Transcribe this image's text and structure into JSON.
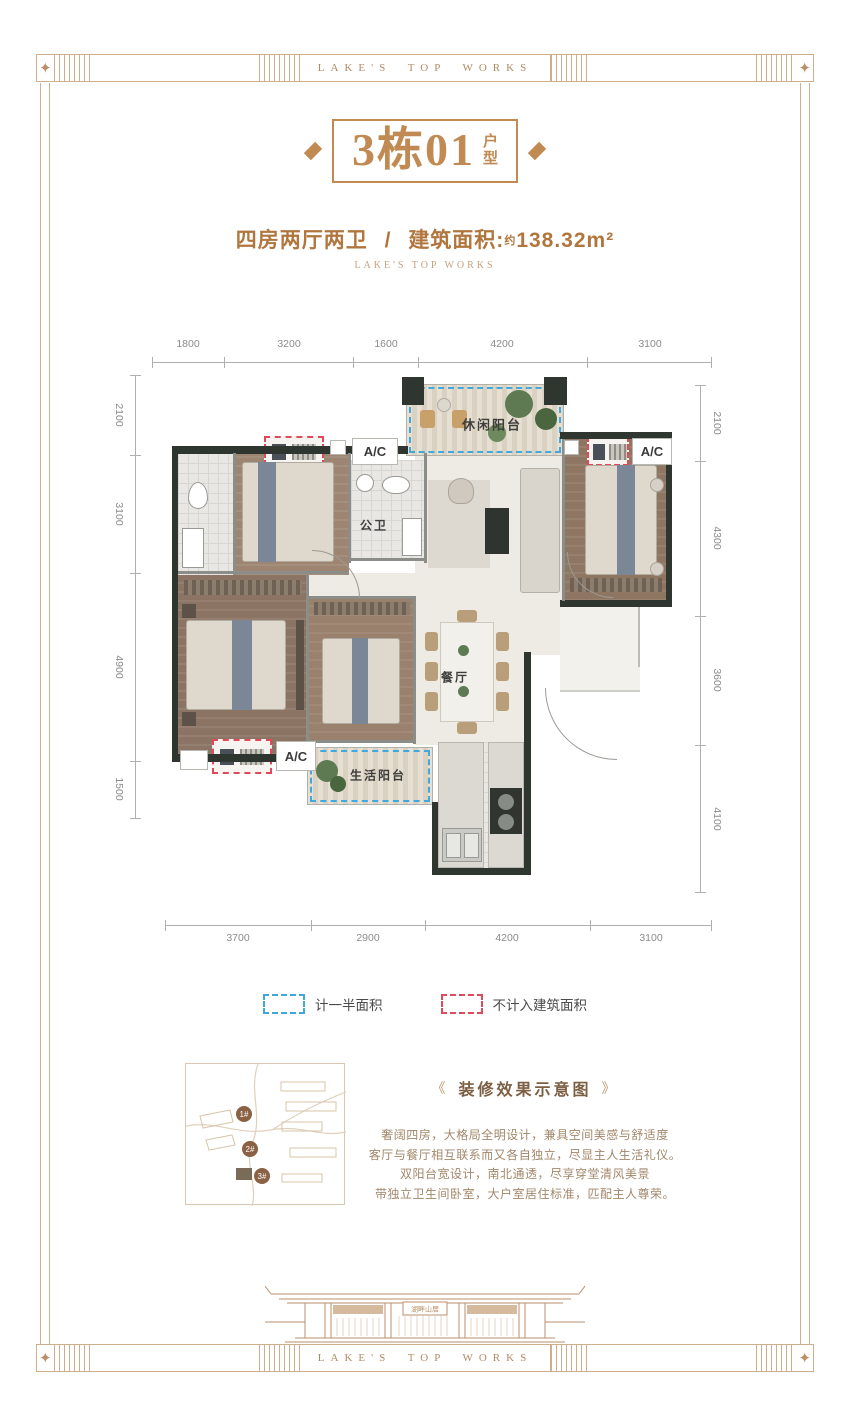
{
  "colors": {
    "accent_bronze": "#c08a52",
    "frame_tan": "#cfae8c",
    "dash_blue": "#3fa8dc",
    "dash_red": "#e0495a",
    "wall_dark": "#2e362f"
  },
  "frame": {
    "band_text": "LAKE'S TOP WORKS"
  },
  "header": {
    "title_main": "3栋01",
    "title_suffix_chars": [
      "户",
      "型"
    ],
    "subtitle_rooms": "四房两厅两卫",
    "subtitle_sep": "/",
    "subtitle_area_label": "建筑面积:",
    "subtitle_approx": "约",
    "subtitle_area_value": "138.32",
    "subtitle_area_unit": "m²",
    "tagline": "LAKE'S TOP WORKS"
  },
  "plan": {
    "dims": {
      "top": [
        "1800",
        "3200",
        "1600",
        "4200",
        "3100"
      ],
      "bottom": [
        "3700",
        "2900",
        "4200",
        "3100"
      ],
      "left": [
        "2100",
        "3100",
        "4900",
        "1500"
      ],
      "right": [
        "2100",
        "4300",
        "3600",
        "4100"
      ]
    },
    "labels": {
      "leisure_balcony": "休闲阳台",
      "public_bath": "公卫",
      "dining": "餐厅",
      "life_balcony": "生活阳台",
      "ac": "A/C"
    }
  },
  "legend": {
    "half_area": "计一半面积",
    "excluded": "不计入建筑面积"
  },
  "sitemap": {
    "buildings": [
      "1#",
      "2#",
      "3#"
    ]
  },
  "description": {
    "title_prefix": "《",
    "title": "装修效果示意图",
    "title_suffix": "》",
    "lines": [
      "奢阔四房，大格局全明设计，兼具空间美感与舒适度",
      "客厅与餐厅相互联系而又各自独立，尽显主人生活礼仪。",
      "双阳台宽设计，南北通透，尽享穿堂清风美景",
      "带独立卫生间卧室，大户室居住标准，匹配主人尊荣。"
    ]
  },
  "footer": {
    "plaque": "湖畔山居",
    "band_text": "LAKE'S TOP WORKS"
  }
}
